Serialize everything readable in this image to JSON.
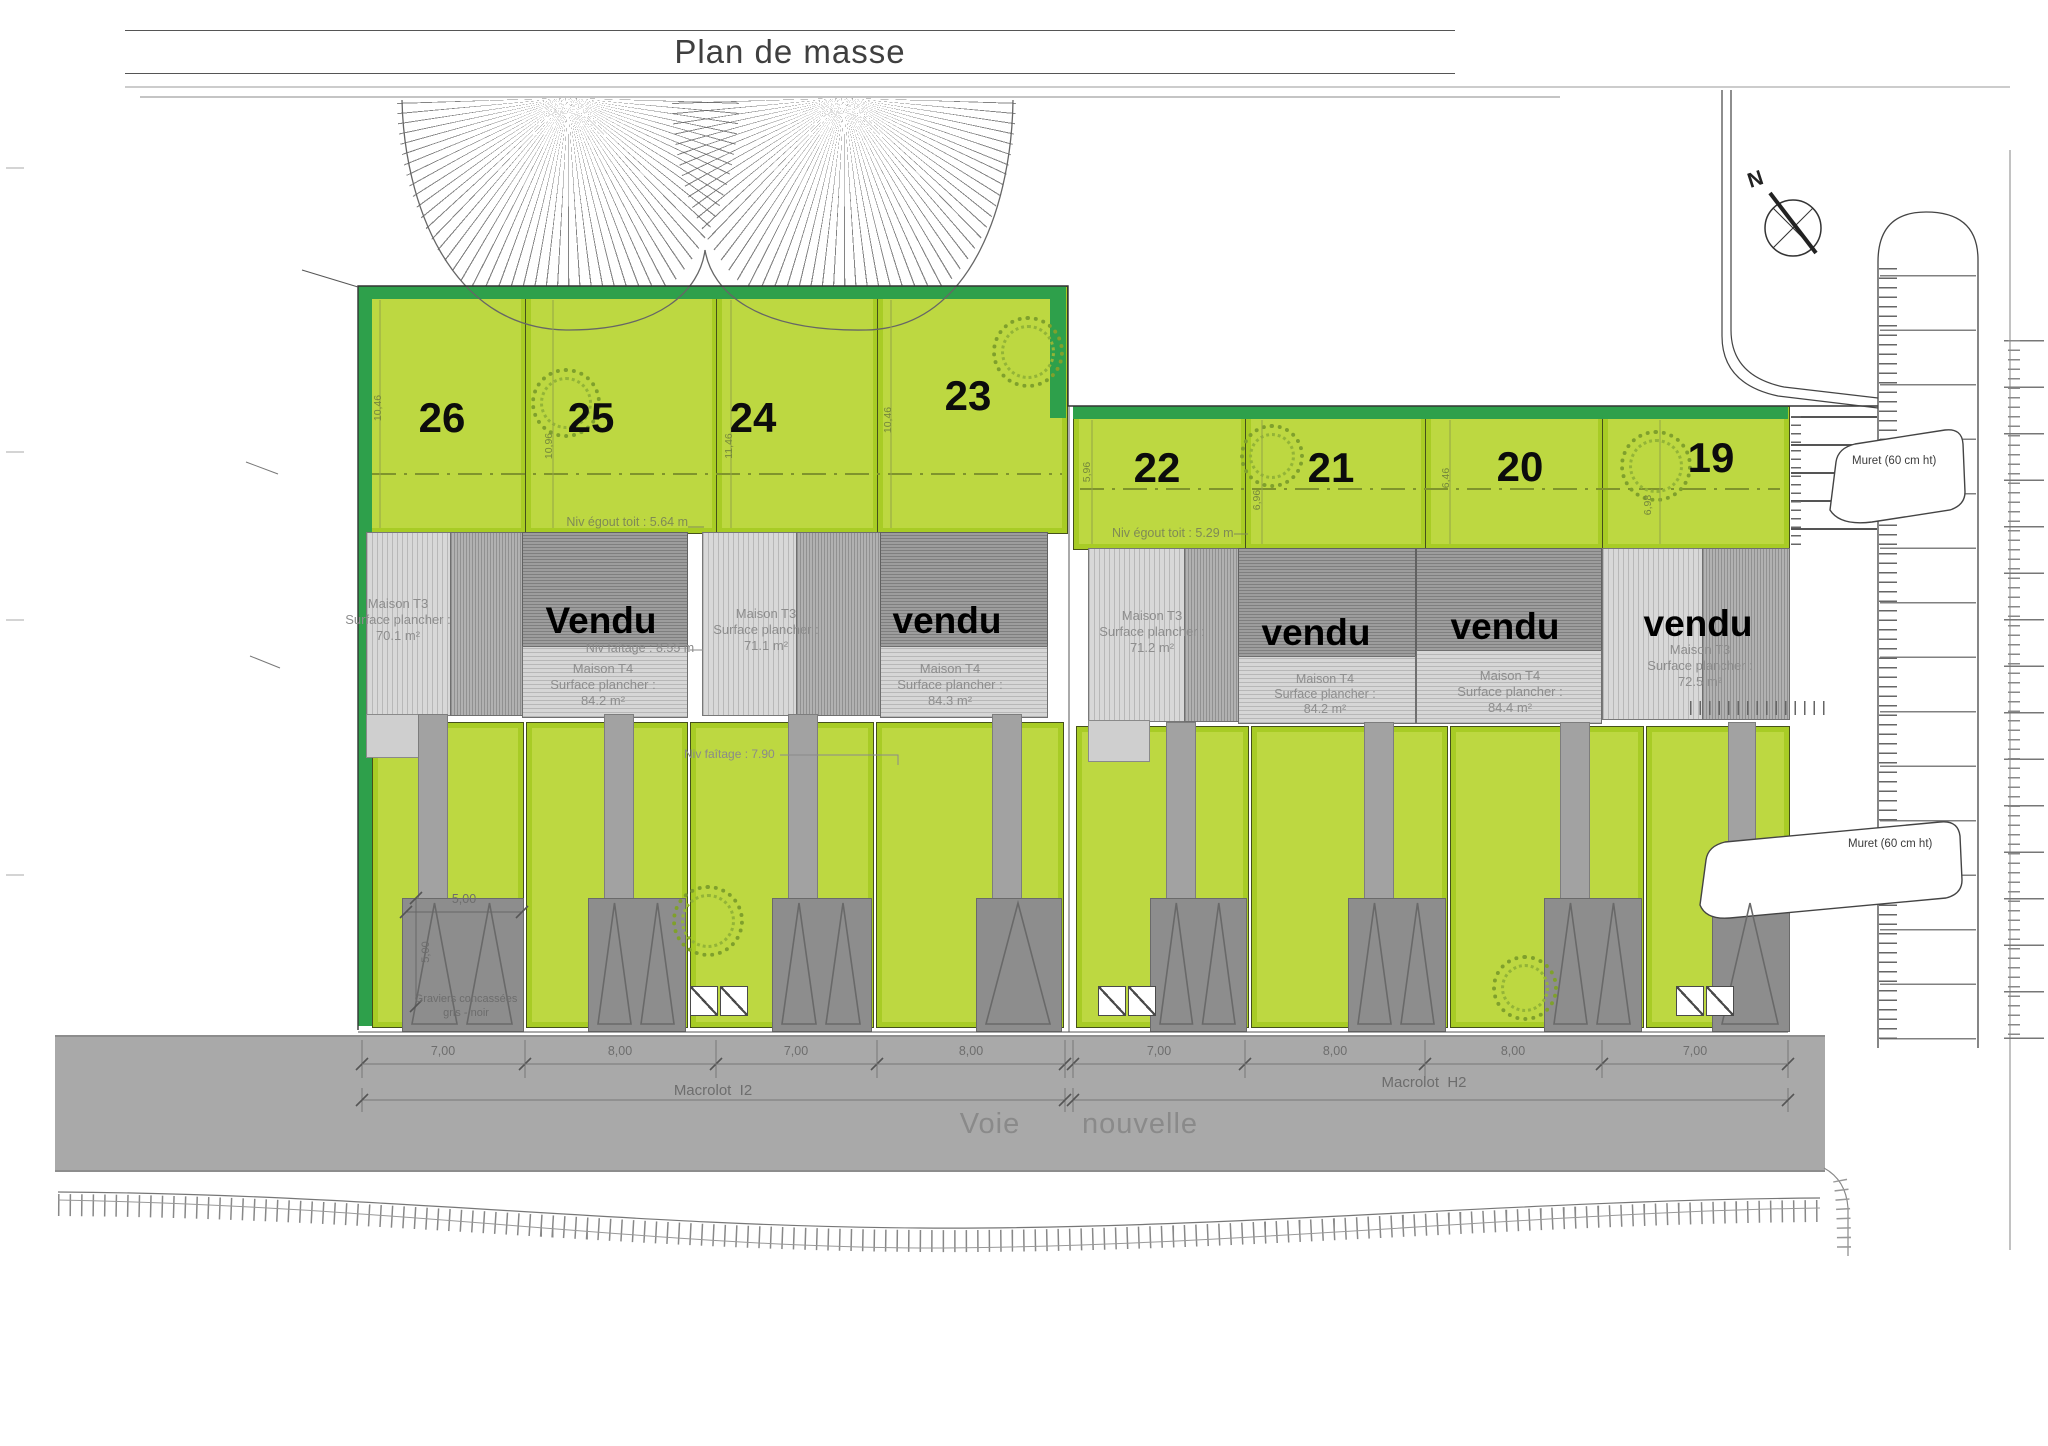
{
  "title": "Plan de masse",
  "compass": {
    "label": "N"
  },
  "colors": {
    "lime": "#bdd841",
    "lime_border": "#a8cc25",
    "green_band": "#2ea04b",
    "building_light": "#d8d8d8",
    "building_dark": "#9d9d9d",
    "driveway": "#8d8d8d",
    "road": "#a9a9a9"
  },
  "lots": [
    {
      "number": "26",
      "depth_dim": "10,46"
    },
    {
      "number": "25",
      "depth_dim": "10,96"
    },
    {
      "number": "24",
      "depth_dim": "11,46"
    },
    {
      "number": "23",
      "depth_dim": "10,46"
    },
    {
      "number": "22",
      "depth_dim": "5,96"
    },
    {
      "number": "21",
      "depth_dim": "6,96"
    },
    {
      "number": "20",
      "depth_dim": "6,46"
    },
    {
      "number": "19",
      "depth_dim": "6,98"
    }
  ],
  "buildings": {
    "t3": [
      {
        "line1": "Maison T3",
        "line2": "Surface plancher :",
        "line3": "70.1 m²"
      },
      {
        "line1": "Maison T3",
        "line2": "Surface plancher :",
        "line3": "71.1 m²"
      },
      {
        "line1": "Maison T3",
        "line2": "Surface plancher :",
        "line3": "71.2 m²"
      },
      {
        "line1": "Maison T3",
        "line2": "Surface plancher :",
        "line3": "72.5 m²"
      }
    ],
    "t4": [
      {
        "line1": "Maison T4",
        "line2": "Surface plancher :",
        "line3": "84.2 m²"
      },
      {
        "line1": "Maison T4",
        "line2": "Surface plancher :",
        "line3": "84.3 m²"
      },
      {
        "line1": "Maison T4",
        "line2": "Surface plancher :",
        "line3": "84.2 m²"
      },
      {
        "line1": "Maison T4",
        "line2": "Surface plancher :",
        "line3": "84.4 m²"
      }
    ],
    "sold": [
      "Vendu",
      "vendu",
      "vendu",
      "vendu",
      "vendu"
    ]
  },
  "annotations": {
    "egout1": "Niv égout toit : 5.64 m",
    "egout2": "Niv égout toit : 5.29 m",
    "faitage1": "Niv faîtage : 8.55 m",
    "faitage2": "Niv faîtage : 7.90",
    "gravel_line1": "Graviers concassées",
    "gravel_line2": "gris - noir",
    "muret": "Muret (60 cm ht)",
    "dim5h": "5,00",
    "dim5v": "5,00"
  },
  "dimensions": {
    "frontage": [
      "7,00",
      "8,00",
      "7,00",
      "8,00",
      "7,00",
      "8,00",
      "8,00",
      "7,00"
    ]
  },
  "macrolots": {
    "left": "Macrolot  I2",
    "right": "Macrolot  H2"
  },
  "road": {
    "word1": "Voie",
    "word2": "nouvelle"
  }
}
